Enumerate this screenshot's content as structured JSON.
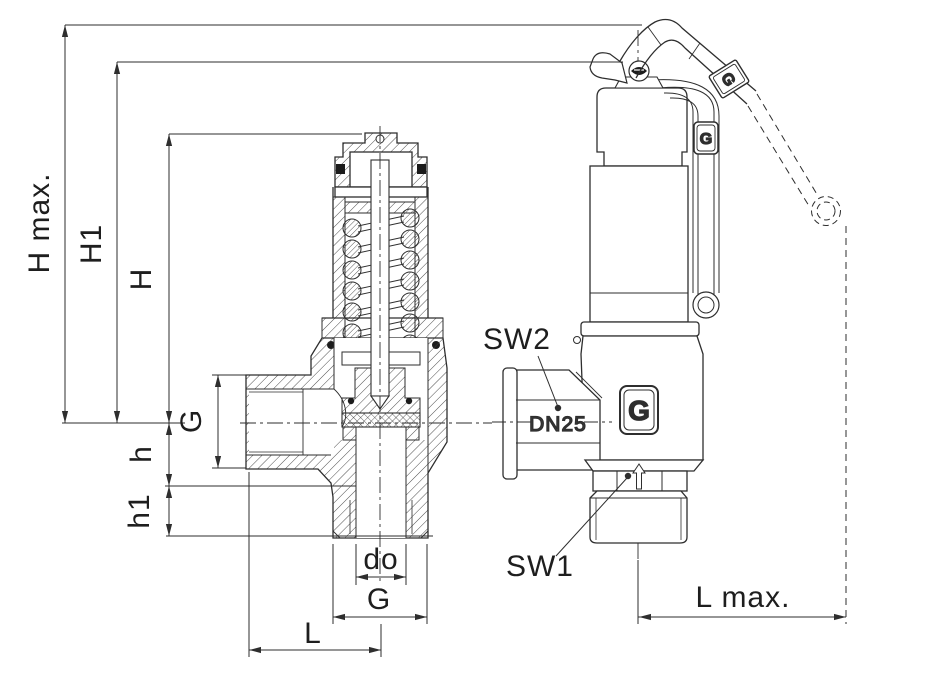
{
  "labels": {
    "h_max": "H max.",
    "h1_upper": "H1",
    "h_upper": "H",
    "g_inlet": "G",
    "h_lower": "h",
    "h1_lower": "h1",
    "d_o": "do",
    "g_outlet": "G",
    "l": "L",
    "sw2": "SW2",
    "dn25": "DN25",
    "sw1": "SW1",
    "l_max": "L max."
  },
  "logo": {
    "letter": "G"
  },
  "colors": {
    "line": "#2e2e2e",
    "text": "#1e1e1e",
    "background": "#ffffff"
  }
}
